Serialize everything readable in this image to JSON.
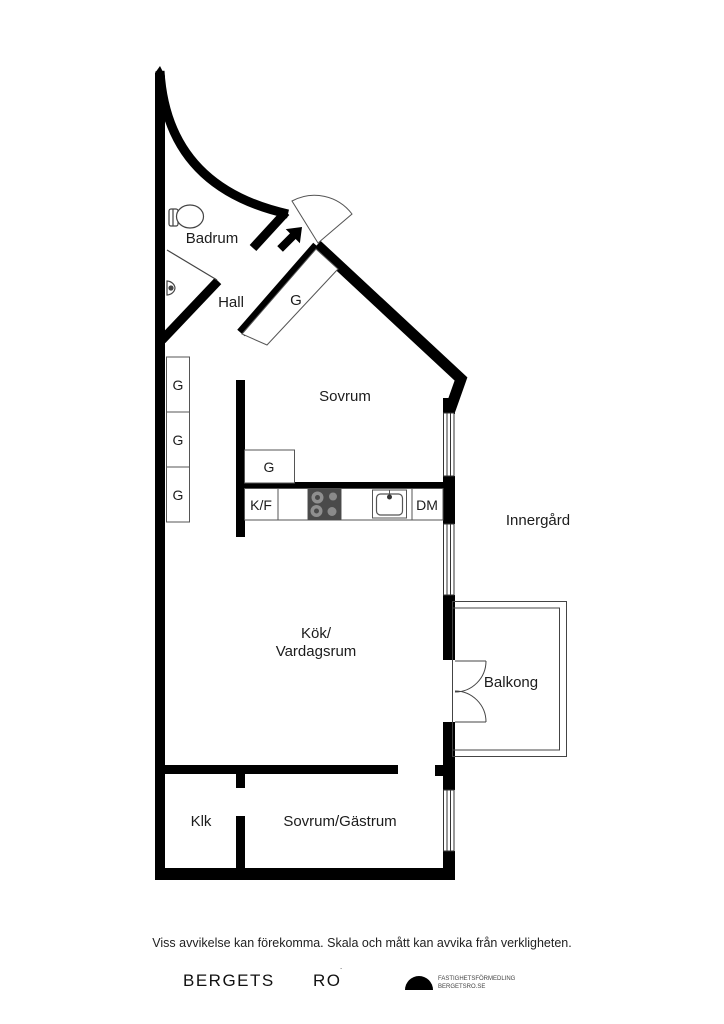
{
  "floorplan": {
    "labels": {
      "badrum": "Badrum",
      "hall": "Hall",
      "hall_closet": "G",
      "sovrum": "Sovrum",
      "closet1": "G",
      "closet2": "G",
      "closet3": "G",
      "kitchen_closet": "G",
      "fridge_freezer": "K/F",
      "dishwasher": "DM",
      "courtyard": "Innergård",
      "kitchen_living_line1": "Kök/",
      "kitchen_living_line2": "Vardagsrum",
      "balcony": "Balkong",
      "walkin_closet": "Klk",
      "guest_room": "Sovrum/Gästrum"
    },
    "colors": {
      "wall": "#000000",
      "thin_line": "#555555",
      "stove_body": "#4a4a4a",
      "burner": "#8f8f8f"
    }
  },
  "footer": {
    "disclaimer": "Viss avvikelse kan förekomma. Skala och mått kan avvika från verkligheten.",
    "brand_left": "BERGETS",
    "brand_right": "RO",
    "brand_mark": "˙",
    "logo_line1": "FASTIGHETSFÖRMEDLING",
    "logo_line2": "BERGETSRO.SE"
  }
}
